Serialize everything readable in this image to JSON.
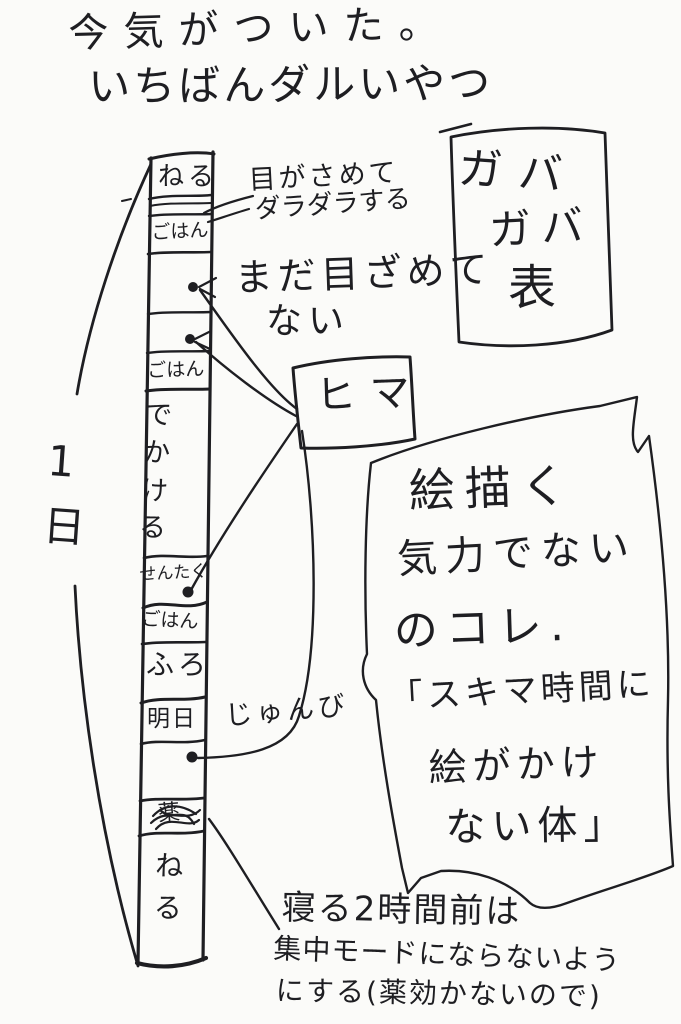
{
  "page": {
    "background": "#fbfbf9",
    "ink": "#1e1e22"
  },
  "title": {
    "line1": "今気がついた。",
    "line2": "いちばんダルいやつ"
  },
  "day_bracket_label": "1日",
  "timeline": {
    "segments": [
      {
        "id": "sleep-top",
        "label": "ねる"
      },
      {
        "id": "wake-band",
        "label": ""
      },
      {
        "id": "meal-1",
        "label": "ごはん"
      },
      {
        "id": "idle-1",
        "label": ""
      },
      {
        "id": "idle-2",
        "label": ""
      },
      {
        "id": "meal-2",
        "label": "ごはん"
      },
      {
        "id": "go-out",
        "label": "でかける"
      },
      {
        "id": "laundry",
        "label": "せんたく"
      },
      {
        "id": "meal-3",
        "label": "ごはん"
      },
      {
        "id": "bath",
        "label": "ふろ"
      },
      {
        "id": "tomorrow-prep",
        "label": "明日"
      },
      {
        "id": "idle-3",
        "label": ""
      },
      {
        "id": "medicine",
        "label": "薬"
      },
      {
        "id": "sleep-bottom",
        "label": "ねる"
      }
    ]
  },
  "annotations": {
    "wake_line1": "目がさめて",
    "wake_line2": "ダラダラする",
    "not_awake_line1": "まだ目ざめて",
    "not_awake_line2": "ない",
    "prep_label": "じゅんび",
    "free_time_box": "ヒマ",
    "gaba_box_line1": "ガバ",
    "gaba_box_line2": "ガバ",
    "gaba_box_line3": "表"
  },
  "big_note": {
    "line1": "絵描く",
    "line2": "気力でない",
    "line3": "のコレ.",
    "line4": "「スキマ時間に",
    "line5": "絵がかけ",
    "line6": "ない体」"
  },
  "bottom_note": {
    "line1": "寝る2時間前は",
    "line2": "集中モードにならないよう",
    "line3": "にする(薬効かないので)"
  }
}
